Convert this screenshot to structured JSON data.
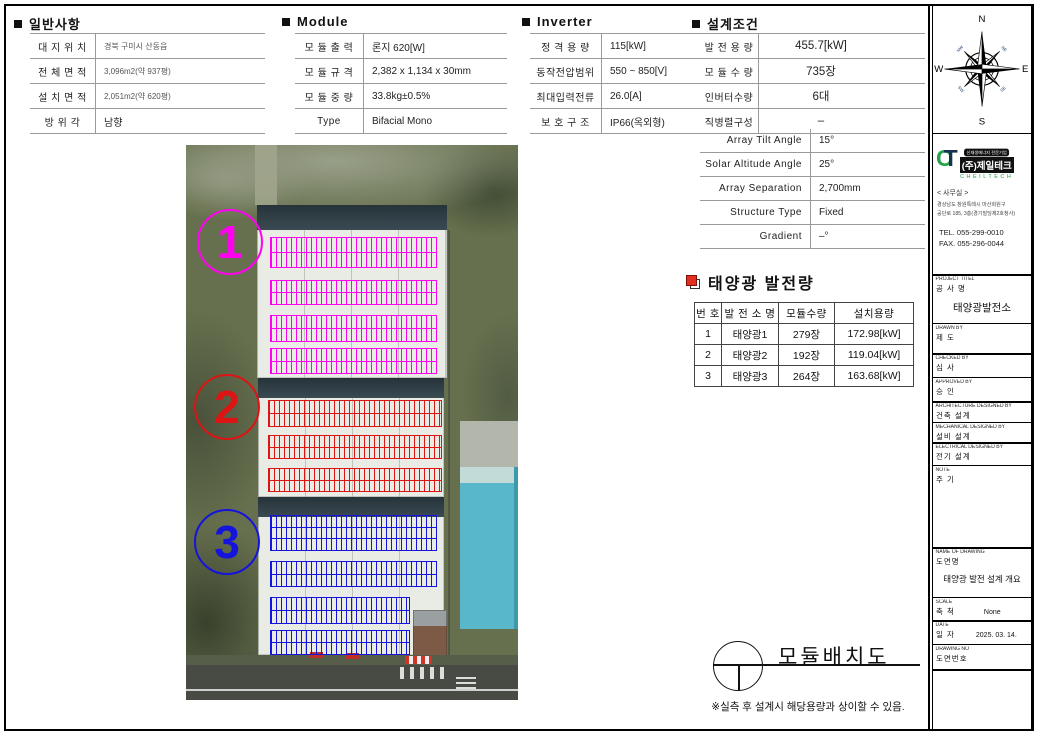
{
  "colors": {
    "area1": "#ff00f0",
    "area2": "#dd1414",
    "area3": "#1414dd"
  },
  "general": {
    "title": "일반사항",
    "rows": [
      {
        "label": "대 지 위 치",
        "value": "경북 구미시 산동읍"
      },
      {
        "label": "전 체 면 적",
        "value": "3,096m2(약 937평)"
      },
      {
        "label": "설 치 면 적",
        "value": "2,051m2(약 620평)"
      },
      {
        "label": "방  위  각",
        "value": "남향"
      }
    ]
  },
  "module": {
    "title": "Module",
    "rows": [
      {
        "label": "모 듈 출 력",
        "value": "론지 620[W]"
      },
      {
        "label": "모 듈 규 격",
        "value": "2,382 x 1,134 x 30mm"
      },
      {
        "label": "모 듈 중 량",
        "value": "33.8kg±0.5%"
      },
      {
        "label": "Type",
        "value": "Bifacial Mono"
      }
    ]
  },
  "inverter": {
    "title": "Inverter",
    "rows": [
      {
        "label": "정 격 용 량",
        "value": "115[kW]"
      },
      {
        "label": "동작전압범위",
        "value": "550 ~ 850[V]"
      },
      {
        "label": "최대입력전류",
        "value": "26.0[A]"
      },
      {
        "label": "보 호 구 조",
        "value": "IP66(옥외형)"
      }
    ]
  },
  "design": {
    "title": "설계조건",
    "rows_a": [
      {
        "label": "발 전 용 량",
        "value": "455.7[kW]"
      },
      {
        "label": "모 듈 수 량",
        "value": "735장"
      },
      {
        "label": "인버터수량",
        "value": "6대"
      },
      {
        "label": "직병렬구성",
        "value": "–"
      }
    ],
    "rows_b": [
      {
        "label": "Array Tilt Angle",
        "value": "15°"
      },
      {
        "label": "Solar Altitude Angle",
        "value": "25°"
      },
      {
        "label": "Array Separation",
        "value": "2,700mm"
      },
      {
        "label": "Structure Type",
        "value": "Fixed"
      },
      {
        "label": "Gradient",
        "value": "–°"
      }
    ]
  },
  "generation": {
    "title": "태양광 발전량",
    "headers": [
      "번 호",
      "발 전 소 명",
      "모듈수량",
      "설치용량"
    ],
    "rows": [
      [
        "1",
        "태양광1",
        "279장",
        "172.98[kW]"
      ],
      [
        "2",
        "태양광2",
        "192장",
        "119.04[kW]"
      ],
      [
        "3",
        "태양광3",
        "264장",
        "163.68[kW]"
      ]
    ]
  },
  "photo": {
    "area_labels": [
      "1",
      "2",
      "3"
    ]
  },
  "compass": {
    "n": "N",
    "e": "E",
    "s": "S",
    "w": "W",
    "ne": "NE",
    "nw": "NW",
    "se": "SE",
    "sw": "SW"
  },
  "company": {
    "logo": {
      "c": "C",
      "t": "T"
    },
    "badge": "신재생에너지 전문기업",
    "name_box": "(주)제일테크",
    "name_en": "CHEILTECH",
    "office_label": "< 사무실 >",
    "address1": "경상남도 창원특례시 마산회원구",
    "address2": "공단로 185, 3층(경기빌딩제2호청사)",
    "tel": "TEL. 055-299-0010",
    "fax": "FAX. 055-296-0044"
  },
  "titleblock": {
    "sections": [
      {
        "en": "PROJECT TITEL",
        "kr": "공 사 명",
        "value": "태양광발전소"
      },
      {
        "en": "DRAWN BY",
        "kr": "제  도",
        "value": ""
      },
      {
        "en": "CHECKED BY",
        "kr": "심  사",
        "value": ""
      },
      {
        "en": "APPROVED BY",
        "kr": "승  인",
        "value": ""
      },
      {
        "en": "ARCHITECTURE DESIGNED BY",
        "kr": "건축 설계",
        "value": ""
      },
      {
        "en": "MECHANICAL DESIGNED BY",
        "kr": "설비 설계",
        "value": ""
      },
      {
        "en": "ELECTRICAL DESIGNED BY",
        "kr": "전기 설계",
        "value": ""
      },
      {
        "en": "NOTE",
        "kr": "주 기",
        "value": ""
      },
      {
        "en": "NAME OF DRAWING",
        "kr": "도면명",
        "value": "태양광 발전 설계 개요"
      },
      {
        "en": "SCALE",
        "kr": "축  척",
        "value": "None"
      },
      {
        "en": "DATE",
        "kr": "일  자",
        "value": "2025. 03. 14."
      },
      {
        "en": "DRAWING NO",
        "kr": "도면번호",
        "value": ""
      }
    ]
  },
  "drawing": {
    "title": "모듈배치도",
    "footnote": "※실측 후 설계시 해당용량과 상이할 수 있음."
  }
}
